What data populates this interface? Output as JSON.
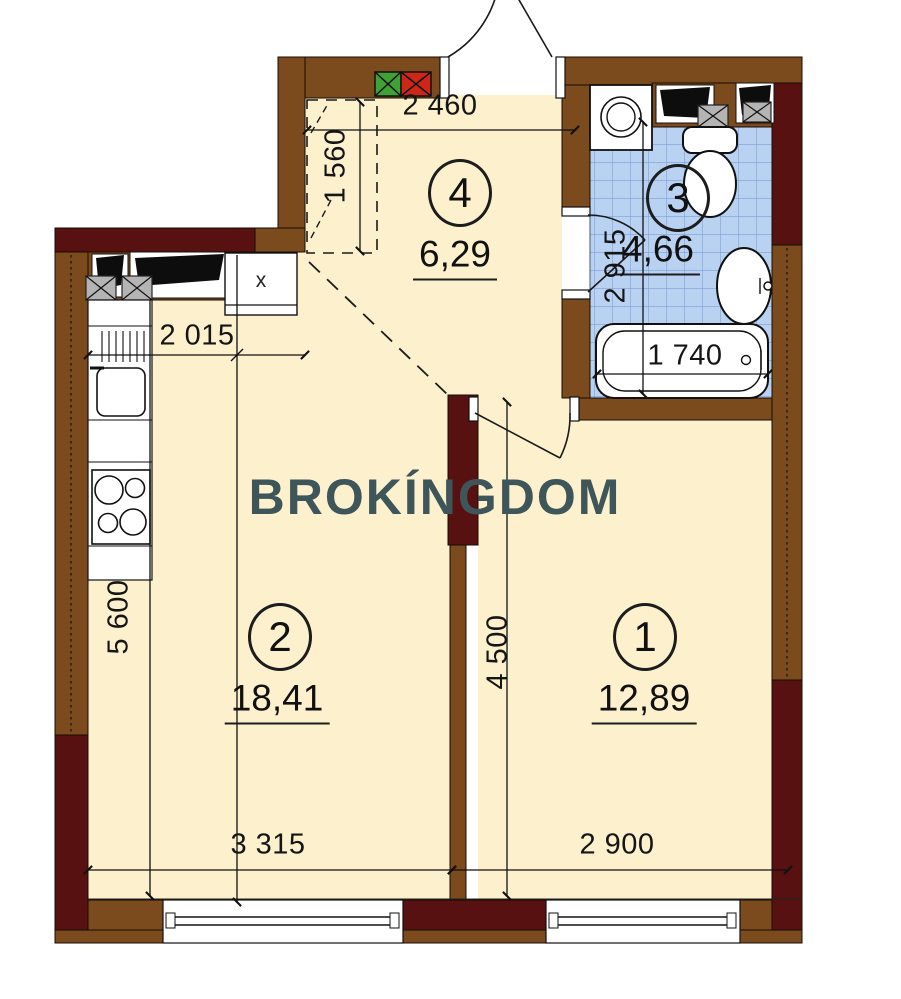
{
  "plan": {
    "watermark": "BROKÍNGDOM",
    "rooms": [
      {
        "number": "1",
        "area": "12,89"
      },
      {
        "number": "2",
        "area": "18,41"
      },
      {
        "number": "3",
        "area": "4,66"
      },
      {
        "number": "4",
        "area": "6,29"
      }
    ],
    "dimensions": {
      "hall_width": "2 460",
      "closet_depth": "1 560",
      "kitchen_width": "2 015",
      "bathroom_height": "2 915",
      "bathtub_length": "1 740",
      "rooms_split_height": "4 500",
      "left_side_height": "5 600",
      "room2_width": "3 315",
      "room1_width": "2 900"
    },
    "cabinet_marker": "x",
    "colors": {
      "wall_brown": "#7b4a1d",
      "wall_dark": "#571111",
      "floor": "#fcf0cd",
      "tile": "#bad2f2",
      "tile_line": "#7d9fd4",
      "watermark": "#3E565A",
      "vent_green": "#3fa234",
      "vent_red": "#cd2718"
    }
  }
}
